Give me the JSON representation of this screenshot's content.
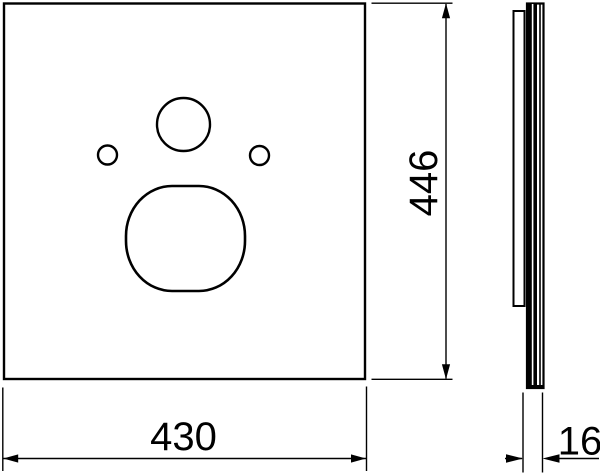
{
  "drawing": {
    "views": {
      "front": {
        "width_label": "430",
        "height_label": "446"
      },
      "side": {
        "thickness_label": "16"
      }
    }
  },
  "colors": {
    "line": "#000000",
    "background": "#ffffff"
  }
}
